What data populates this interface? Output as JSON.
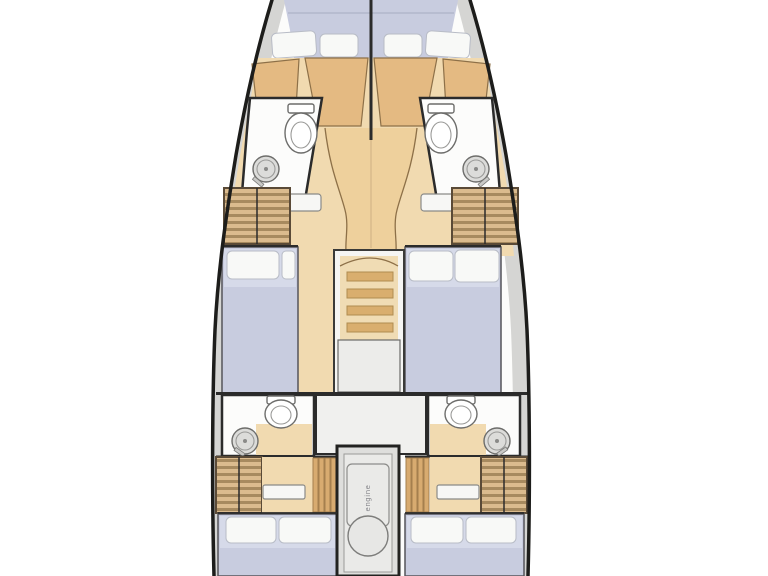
{
  "diagram": {
    "type": "yacht-floor-plan",
    "view": "top-down, bow up, bow and stern cropped by image edges",
    "sections": {
      "forward": [
        "v-berth-cabin-port",
        "v-berth-cabin-starboard",
        "head-with-toilet-and-washbasin-port",
        "head-with-toilet-and-washbasin-starboard",
        "wardrobe-port",
        "wardrobe-starboard"
      ],
      "midship": [
        "single-berth-cabin-port",
        "double-berth-cabin-starboard",
        "companionway-stairs",
        "landing"
      ],
      "aft": [
        "head-with-toilet-and-washbasin-port",
        "head-with-toilet-and-washbasin-starboard",
        "central-lobby",
        "engine-compartment",
        "double-berth-cabin-port",
        "double-berth-cabin-starboard"
      ]
    }
  },
  "engine": {
    "label": "engine"
  },
  "colors": {
    "hull_outline": "#1d1d1b",
    "deck": "#d5d5d3",
    "interior_white": "#fcfcfb",
    "wood_light": "#f1dab0",
    "wood_mid": "#e4ba82",
    "wood_corridor": "#eed09c",
    "wood_edge": "#8d7048",
    "slat_light": "#dbbb8e",
    "slat_dark": "#a78a5f",
    "slat_vertical": "#d8ab70",
    "bed": "#c8ccdf",
    "bed_light": "#d6dae9",
    "pillow": "#f8f9f7",
    "fixture_gray": "#dcdcda",
    "landing": "#ececea",
    "engine_box": "#dededc",
    "tread": "#d9ae6e",
    "tread_bg": "#f0dcb4",
    "seam": "#a6abc0",
    "wall": "#2b2b2b"
  }
}
